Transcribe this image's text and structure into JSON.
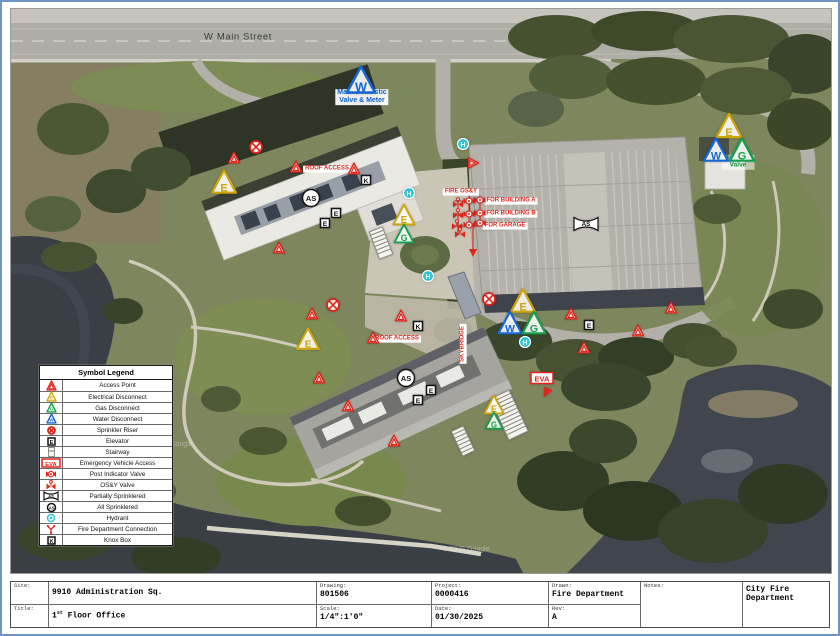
{
  "legend": {
    "title": "Symbol Legend",
    "items": [
      {
        "icon": "access",
        "label": "Access Point"
      },
      {
        "icon": "elec",
        "label": "Electrical Disconnect"
      },
      {
        "icon": "gas",
        "label": "Gas Disconnect"
      },
      {
        "icon": "water",
        "label": "Water Disconnect"
      },
      {
        "icon": "riser",
        "label": "Sprinkler Riser"
      },
      {
        "icon": "elevator",
        "label": "Elevator"
      },
      {
        "icon": "stair",
        "label": "Stairway"
      },
      {
        "icon": "eva",
        "label": "Emergency Vehicle Access"
      },
      {
        "icon": "piv",
        "label": "Post Indicator Valve"
      },
      {
        "icon": "osy",
        "label": "OS&Y Valve"
      },
      {
        "icon": "as_bowtie",
        "label": "Partially Sprinklered"
      },
      {
        "icon": "as_circle",
        "label": "All Sprinklered"
      },
      {
        "icon": "hydrant",
        "label": "Hydrant"
      },
      {
        "icon": "fdc",
        "label": "Fire Department Connection"
      },
      {
        "icon": "knox",
        "label": "Knox Box"
      }
    ]
  },
  "map": {
    "colors": {
      "access": "#e0241a",
      "electrical": "#cfa60a",
      "gas": "#14a04c",
      "water": "#1767d2",
      "hydrant": "#2cc2d8",
      "black": "#141414",
      "label_red": "#e0251b",
      "label_blue": "#1064c8",
      "label_green": "#0e8f3c"
    },
    "markers": [
      {
        "type": "water",
        "x": 350,
        "y": 71,
        "s": 30
      },
      {
        "type": "hydrant",
        "x": 452,
        "y": 135
      },
      {
        "type": "access",
        "x": 462,
        "y": 154,
        "s": 12,
        "rot": 90
      },
      {
        "type": "elec",
        "x": 718,
        "y": 117,
        "s": 27
      },
      {
        "type": "water",
        "x": 705,
        "y": 141,
        "s": 26
      },
      {
        "type": "gas",
        "x": 731,
        "y": 141,
        "s": 26
      },
      {
        "type": "riser",
        "x": 245,
        "y": 138
      },
      {
        "type": "access",
        "x": 223,
        "y": 149,
        "s": 13
      },
      {
        "type": "access",
        "x": 285,
        "y": 158,
        "s": 13
      },
      {
        "type": "access",
        "x": 343,
        "y": 160,
        "s": 13
      },
      {
        "type": "elec",
        "x": 213,
        "y": 173,
        "s": 26
      },
      {
        "type": "knox",
        "x": 355,
        "y": 171
      },
      {
        "type": "hydrant",
        "x": 398,
        "y": 184
      },
      {
        "type": "as_circle",
        "x": 300,
        "y": 189
      },
      {
        "type": "elevator",
        "x": 325,
        "y": 204
      },
      {
        "type": "elevator",
        "x": 314,
        "y": 214
      },
      {
        "type": "elec",
        "x": 393,
        "y": 206,
        "s": 23
      },
      {
        "type": "gas",
        "x": 393,
        "y": 225,
        "s": 21
      },
      {
        "type": "stair",
        "x": 370,
        "y": 234,
        "rot": -21,
        "w": 15,
        "h": 30
      },
      {
        "type": "access",
        "x": 268,
        "y": 239,
        "s": 13
      },
      {
        "type": "hydrant",
        "x": 417,
        "y": 267
      },
      {
        "type": "riser",
        "x": 322,
        "y": 296
      },
      {
        "type": "access",
        "x": 301,
        "y": 305,
        "s": 13
      },
      {
        "type": "access",
        "x": 390,
        "y": 307,
        "s": 13
      },
      {
        "type": "knox",
        "x": 407,
        "y": 317
      },
      {
        "type": "elec",
        "x": 297,
        "y": 330,
        "s": 24
      },
      {
        "type": "access",
        "x": 362,
        "y": 329,
        "s": 13
      },
      {
        "type": "access",
        "x": 308,
        "y": 369,
        "s": 13
      },
      {
        "type": "as_circle",
        "x": 395,
        "y": 369
      },
      {
        "type": "elevator",
        "x": 420,
        "y": 381
      },
      {
        "type": "elevator",
        "x": 407,
        "y": 391
      },
      {
        "type": "access",
        "x": 337,
        "y": 397,
        "s": 13
      },
      {
        "type": "access",
        "x": 383,
        "y": 432,
        "s": 13
      },
      {
        "type": "stair",
        "x": 452,
        "y": 432,
        "rot": -25,
        "w": 14,
        "h": 28
      },
      {
        "type": "stair",
        "x": 498,
        "y": 406,
        "rot": -25,
        "w": 22,
        "h": 46
      },
      {
        "type": "elec",
        "x": 483,
        "y": 396,
        "s": 21
      },
      {
        "type": "gas",
        "x": 483,
        "y": 412,
        "s": 19
      },
      {
        "type": "riser",
        "x": 478,
        "y": 290
      },
      {
        "type": "elec",
        "x": 512,
        "y": 292,
        "s": 26
      },
      {
        "type": "water",
        "x": 499,
        "y": 314,
        "s": 25
      },
      {
        "type": "gas",
        "x": 523,
        "y": 314,
        "s": 25
      },
      {
        "type": "access",
        "x": 560,
        "y": 305,
        "s": 13
      },
      {
        "type": "elevator",
        "x": 578,
        "y": 316
      },
      {
        "type": "hydrant",
        "x": 514,
        "y": 333
      },
      {
        "type": "access",
        "x": 573,
        "y": 339,
        "s": 13
      },
      {
        "type": "eva",
        "x": 531,
        "y": 369
      },
      {
        "type": "arrow",
        "x": 535,
        "y": 384,
        "rot": 28
      },
      {
        "type": "access",
        "x": 627,
        "y": 322,
        "s": 13
      },
      {
        "type": "access",
        "x": 660,
        "y": 299,
        "s": 13
      },
      {
        "type": "as_bowtie",
        "x": 575,
        "y": 215
      },
      {
        "type": "osy",
        "x": 447,
        "y": 194
      },
      {
        "type": "osy",
        "x": 447,
        "y": 205
      },
      {
        "type": "osy",
        "x": 446,
        "y": 216
      },
      {
        "type": "osy",
        "x": 449,
        "y": 224
      },
      {
        "type": "piv",
        "x": 458,
        "y": 192
      },
      {
        "type": "piv",
        "x": 469,
        "y": 191
      },
      {
        "type": "piv",
        "x": 458,
        "y": 205
      },
      {
        "type": "piv",
        "x": 469,
        "y": 204
      },
      {
        "type": "piv",
        "x": 458,
        "y": 216
      },
      {
        "type": "piv",
        "x": 469,
        "y": 214
      }
    ],
    "labels": [
      {
        "id": "street-name",
        "lines": [
          "W Main Street"
        ],
        "x": 227,
        "y": 29,
        "color": "#3b3b3b",
        "bg": "none",
        "fs": 9.5,
        "bold": false,
        "ls": 0.6
      },
      {
        "id": "main-domestic-valve",
        "lines": [
          "Main Domestic",
          "Valve & Meter"
        ],
        "x": 351,
        "y": 88,
        "color": "#1064c8",
        "bg": "rgba(255,255,255,0.92)",
        "fs": 7,
        "bold": true
      },
      {
        "id": "main-gas-valve",
        "lines": [
          "Main Gas",
          "Valve"
        ],
        "x": 727,
        "y": 153,
        "color": "#0e8f3c",
        "bg": "rgba(255,255,255,0.55)",
        "fs": 6.5,
        "bold": true
      },
      {
        "id": "fire-osy",
        "lines": [
          "FIRE OS&Y"
        ],
        "x": 450,
        "y": 183,
        "color": "#e0251b",
        "bg": "#ffffff",
        "fs": 6,
        "bold": true
      },
      {
        "id": "for-building-a",
        "lines": [
          "FOR BUILDING A"
        ],
        "x": 500,
        "y": 192,
        "color": "#e0251b",
        "bg": "#ffffff",
        "fs": 6,
        "bold": true
      },
      {
        "id": "for-building-b",
        "lines": [
          "FOR BUILDING B"
        ],
        "x": 500,
        "y": 205,
        "color": "#e0251b",
        "bg": "#ffffff",
        "fs": 6,
        "bold": true
      },
      {
        "id": "for-garage",
        "lines": [
          "FOR GARAGE"
        ],
        "x": 494,
        "y": 217,
        "color": "#e0251b",
        "bg": "#ffffff",
        "fs": 6,
        "bold": true
      },
      {
        "id": "roof-access-a",
        "lines": [
          "ROOF ACCESS"
        ],
        "x": 316,
        "y": 160,
        "color": "#e0251b",
        "bg": "#ffffff",
        "fs": 6,
        "bold": true
      },
      {
        "id": "roof-access-b",
        "lines": [
          "ROOF ACCESS"
        ],
        "x": 386,
        "y": 330,
        "color": "#e0251b",
        "bg": "#ffffff",
        "fs": 6,
        "bold": true
      },
      {
        "id": "skybridge",
        "lines": [
          "SKYBRIDGE"
        ],
        "x": 452,
        "y": 335,
        "color": "#e0251b",
        "bg": "#ffffff",
        "fs": 6,
        "bold": true,
        "rot": -90
      },
      {
        "id": "watermark-1",
        "lines": [
          "© 2025 Google"
        ],
        "x": 158,
        "y": 436,
        "color": "rgba(235,235,235,0.45)",
        "bg": "none",
        "fs": 7,
        "bold": false
      },
      {
        "id": "watermark-2",
        "lines": [
          "© 2025 Google"
        ],
        "x": 455,
        "y": 541,
        "color": "rgba(235,235,235,0.45)",
        "bg": "none",
        "fs": 7,
        "bold": false
      }
    ]
  },
  "title_block": {
    "site_label": "Site:",
    "site_value": "9910 Administration Sq.",
    "title_label": "Title:",
    "title_value_num": "1",
    "title_value_sup": "st",
    "title_value_rest": " Floor Office",
    "drawing_label": "Drawing:",
    "drawing_value": "801506",
    "scale_label": "Scale:",
    "scale_value": "1/4\":1'0\"",
    "project_label": "Project:",
    "project_value": "0000416",
    "date_label": "Date:",
    "date_value": "01/30/2025",
    "drawn_label": "Drawn:",
    "drawn_value": "Fire Department",
    "rev_label": "Rev:",
    "rev_value": "A",
    "notes_label": "Notes:",
    "department": "City Fire Department"
  }
}
